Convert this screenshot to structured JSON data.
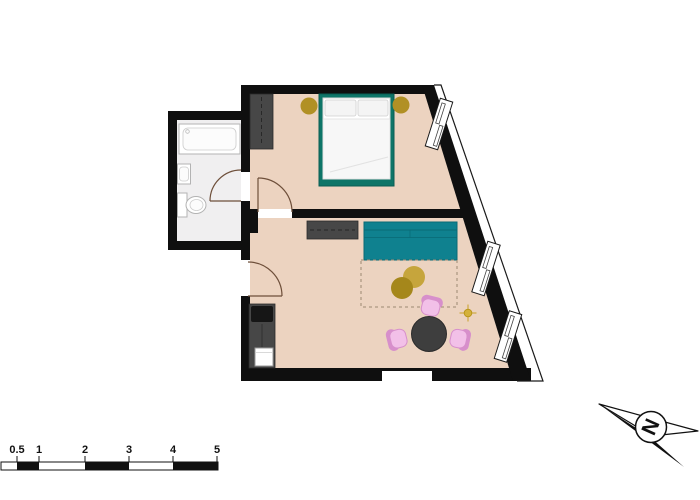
{
  "north": {
    "label": "N"
  },
  "scale_bar": {
    "labels": [
      "0.5",
      "1",
      "2",
      "3",
      "4",
      "5"
    ]
  },
  "colors": {
    "wall": "#0f0f0f",
    "floor": "#ecd3c0",
    "bathfloor": "#f0eff0",
    "bedteal": "#0e7568",
    "sofateal": "#0f818f",
    "gold": "#b19025",
    "goldlight": "#c6a53c",
    "golddark": "#a5871b",
    "lightgold": "#c9a227",
    "graydark": "#474747",
    "tablegray": "#3e3e3e",
    "appliance": "#161616",
    "pink": "#f2c0e8",
    "pinkdark": "#d78fcb",
    "doorarc": "#6e4f3a",
    "rugdash": "#9b8872"
  }
}
